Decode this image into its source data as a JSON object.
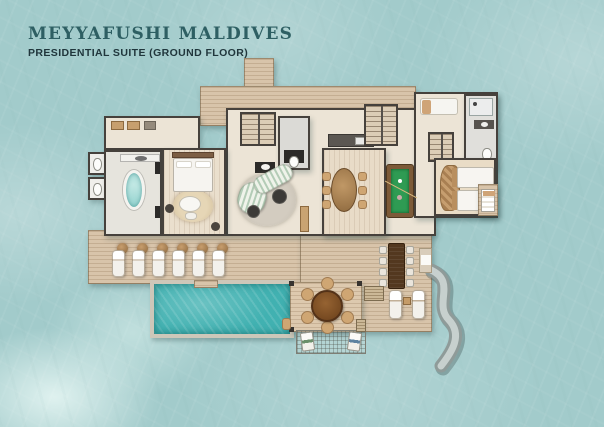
{
  "header": {
    "title": "MEYYAFUSHI MALDIVES",
    "subtitle": "PRESIDENTIAL SUITE (GROUND FLOOR)"
  },
  "colors": {
    "title_text": "#2e5f63",
    "subtitle_text": "#20363c",
    "water": "#a2cbcb",
    "pool_water": "#41b1b1",
    "deck_wood": "#d8c4aa",
    "interior_floor": "#ece4d6",
    "wall": "#46413c",
    "billiard_felt": "#2f9b53",
    "bathtub": "#8fd1cd",
    "slide": "#8f9b99"
  },
  "plan": {
    "description": "Top-down illustrated floor plan of an overwater presidential suite surrounded by sea",
    "rooms": [
      "jetty-walkway",
      "arrival-deck",
      "dressing-room",
      "wc",
      "master-bathroom",
      "master-bedroom",
      "entry-foyer",
      "powder-room",
      "living-room",
      "dining-room",
      "kitchen",
      "main-staircase",
      "games-room",
      "guest-lounge",
      "guest-bathroom",
      "guest-bedroom",
      "sun-deck",
      "swimming-pool",
      "pergola-dining-deck",
      "overwater-net",
      "water-slide"
    ],
    "furniture_counts": {
      "sun_loungers_row": 6,
      "round_table_chairs": 6,
      "long_table_chairs": 8,
      "dining_room_chairs": 6,
      "twin_beds": 2,
      "net_cushions": 2,
      "pool_loungers_pair": 2
    }
  }
}
